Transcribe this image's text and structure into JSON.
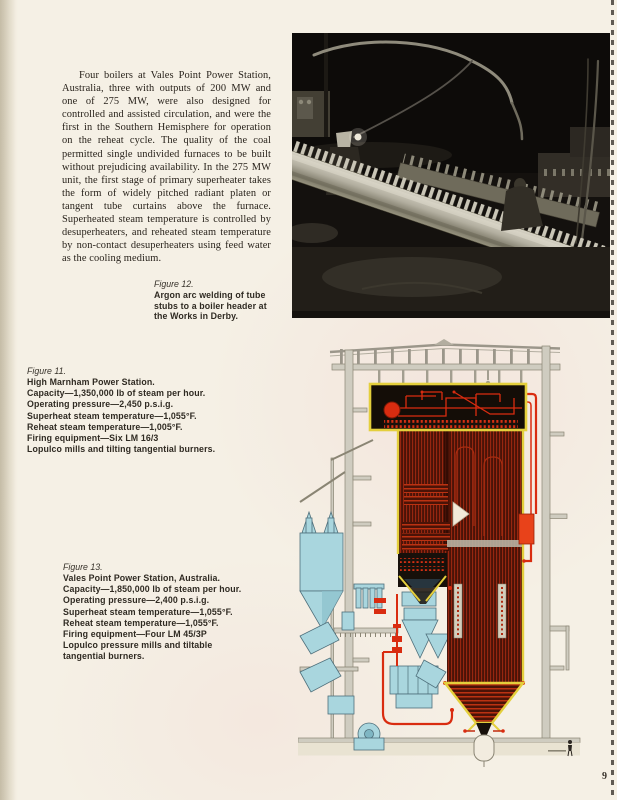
{
  "page": {
    "number": "9"
  },
  "intro": {
    "text": "Four boilers at Vales Point Power Station, Australia, three with outputs of 200 MW and one of 275 MW, were also designed for controlled and assisted circulation, and were the first in the Southern Hemisphere for operation on the reheat cycle.  The quality of the coal permitted single undivided furnaces to be built without prejudicing availability.  In the 275 MW unit, the first stage of primary superheater takes the form of widely pitched radiant platen or tangent tube curtains above the furnace.  Superheated steam temperature is controlled by desuperheaters, and reheated steam temperature by non-contact desuperheaters using feed water as the cooling medium."
  },
  "figure12": {
    "label": "Figure 12.",
    "lines": [
      "Argon arc welding of tube",
      "stubs to a boiler header at",
      "the Works in Derby."
    ]
  },
  "figure11": {
    "label": "Figure 11.",
    "lines": [
      "High Marnham Power Station.",
      "Capacity—1,350,000 lb of steam per hour.",
      "Operating pressure—2,450 p.s.i.g.",
      "Superheat steam temperature—1,055°F.",
      "Reheat steam temperature—1,005°F.",
      "Firing equipment—Six LM 16/3",
      "Lopulco mills and tilting tangential burners."
    ]
  },
  "figure13": {
    "label": "Figure 13.",
    "lines": [
      "Vales Point Power Station, Australia.",
      "Capacity—1,850,000 lb of steam per hour.",
      "Operating pressure—2,400 p.s.i.g.",
      "Superheat steam temperature—1,055°F.",
      "Reheat steam temperature—1,055°F.",
      "Firing equipment—Four LM 45/3P",
      "Lopulco pressure mills and tiltable",
      "tangential burners."
    ]
  },
  "colors": {
    "paper": "#f5f0e5",
    "furnace_maroon": "#4a1307",
    "tube_red": "#d92c10",
    "outline_yellow": "#e4cf3c",
    "plant_cyan": "#a9d6de",
    "steel_grey": "#cfccc0",
    "photo_black": "#14110e"
  }
}
